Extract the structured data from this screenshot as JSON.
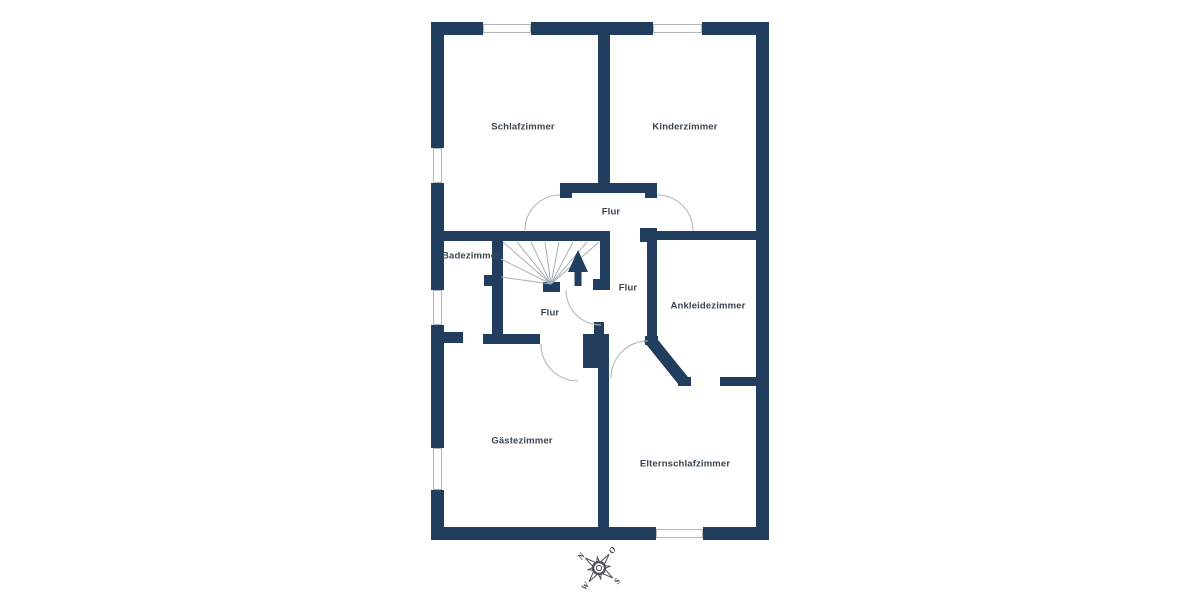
{
  "plan": {
    "title": "Obergeschoss Grundriss",
    "rooms": [
      {
        "name": "schlafzimmer",
        "label": "Schlafzimmer"
      },
      {
        "name": "kinderzimmer",
        "label": "Kinderzimmer"
      },
      {
        "name": "flur-oben",
        "label": "Flur"
      },
      {
        "name": "badezimmer",
        "label": "Badezimmer"
      },
      {
        "name": "flur-mitte",
        "label": "Flur"
      },
      {
        "name": "ankleidezimmer",
        "label": "Ankleidezimmer"
      },
      {
        "name": "flur-unten",
        "label": "Flur"
      },
      {
        "name": "gaestezimmer",
        "label": "Gästezimmer"
      },
      {
        "name": "elternschlafzimmer",
        "label": "Elternschlafzimmer"
      }
    ],
    "features": [
      "staircase-with-up-arrow",
      "5-door-swing-arcs",
      "6-windows",
      "chimney-block",
      "diagonal-wall"
    ]
  },
  "compass": {
    "rotation_deg": -54,
    "points": [
      {
        "label": "N"
      },
      {
        "label": "O"
      },
      {
        "label": "S"
      },
      {
        "label": "W"
      }
    ]
  },
  "colors": {
    "wall": "#223e5e",
    "line": "#b3b7bb",
    "stair_line": "#a8adb3",
    "text": "#394551",
    "compass": "#4d535b",
    "background": "#ffffff"
  }
}
